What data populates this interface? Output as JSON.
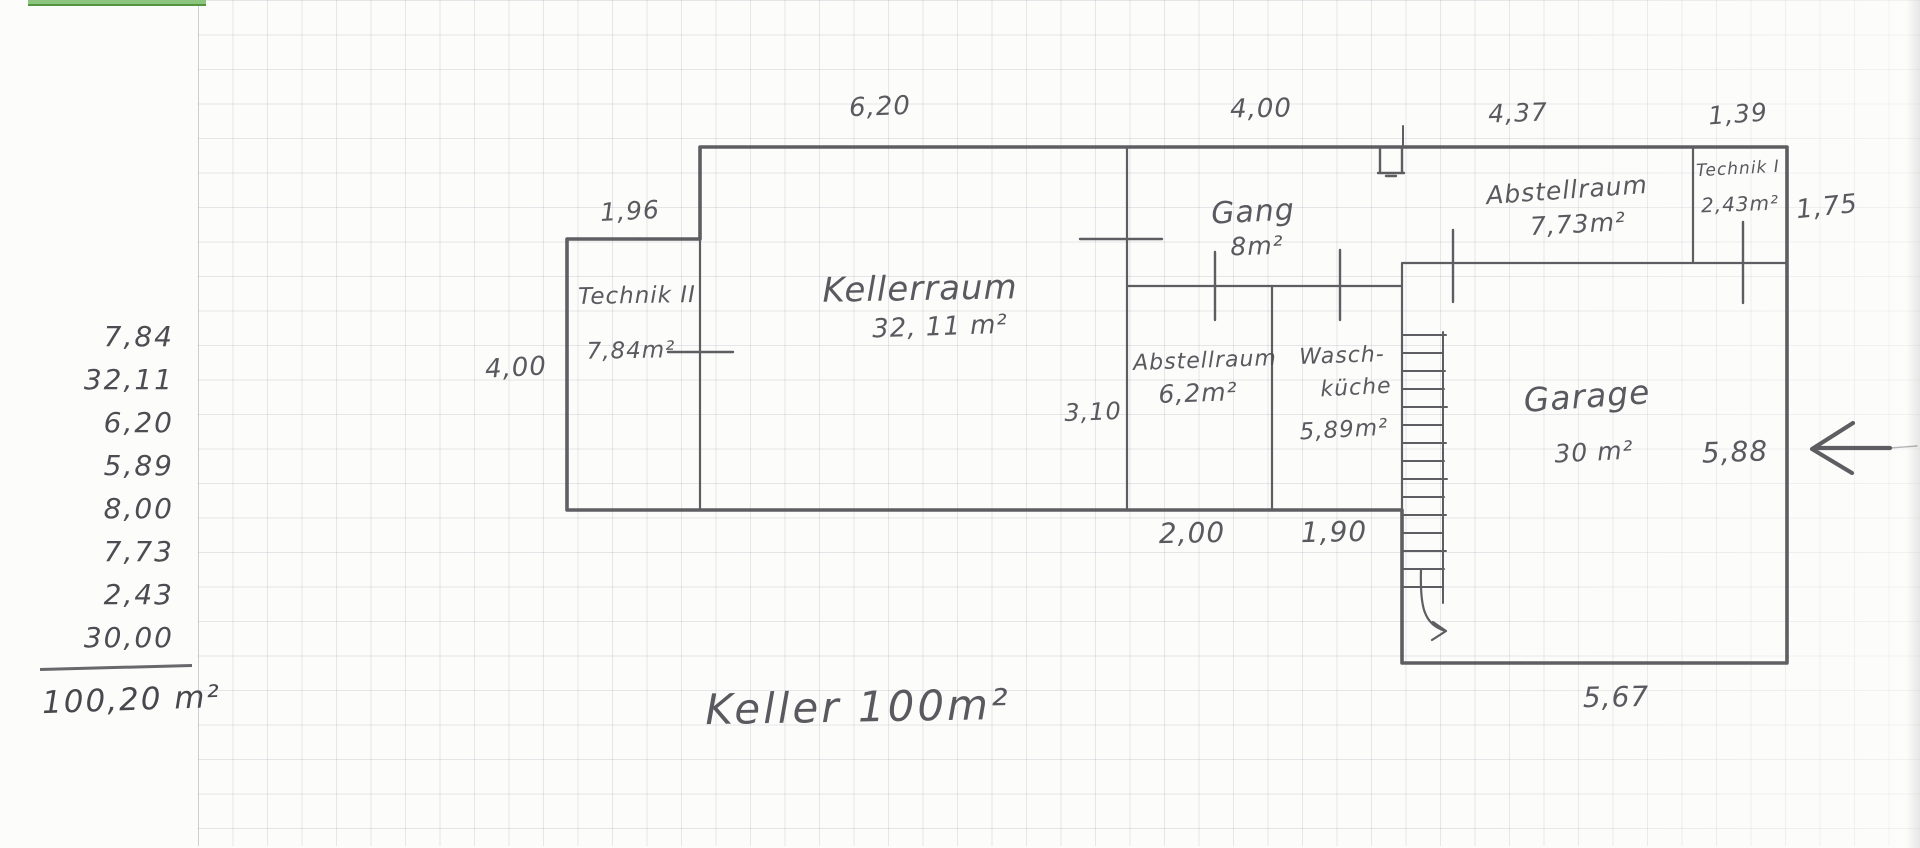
{
  "title": "Keller 100m²",
  "calculation": {
    "entries": [
      "7,84",
      "32,11",
      "6,20",
      "5,89",
      "8,00",
      "7,73",
      "2,43",
      "30,00"
    ],
    "total": "100,20 m²"
  },
  "rooms": {
    "technik2": {
      "name": "Technik II",
      "area": "7,84m²"
    },
    "kellerraum": {
      "name": "Kellerraum",
      "area": "32, 11 m²"
    },
    "gang": {
      "name": "Gang",
      "area": "8m²"
    },
    "abstellraum_mitte": {
      "name": "Abstellraum",
      "area": "6,2m²"
    },
    "waschkueche": {
      "name_line1": "Wasch-",
      "name_line2": "küche",
      "area": "5,89m²"
    },
    "abstellraum_oben": {
      "name": "Abstellraum",
      "area": "7,73m²"
    },
    "technik1": {
      "name": "Technik I",
      "area": "2,43m²"
    },
    "garage": {
      "name": "Garage",
      "area": "30 m²"
    }
  },
  "dimensions": {
    "top": [
      "6,20",
      "4,00",
      "4,37",
      "1,39"
    ],
    "annex": {
      "width": "1,96",
      "height": "4,00"
    },
    "technik1_height": "1,75",
    "mid_height": "3,10",
    "bottom": [
      "2,00",
      "1,90"
    ],
    "garage": {
      "height": "5,88",
      "width": "5,67"
    }
  },
  "colors": {
    "pencil": "#49494e",
    "grid": "#c6ccd8",
    "highlight_green": "#8cc57d"
  }
}
